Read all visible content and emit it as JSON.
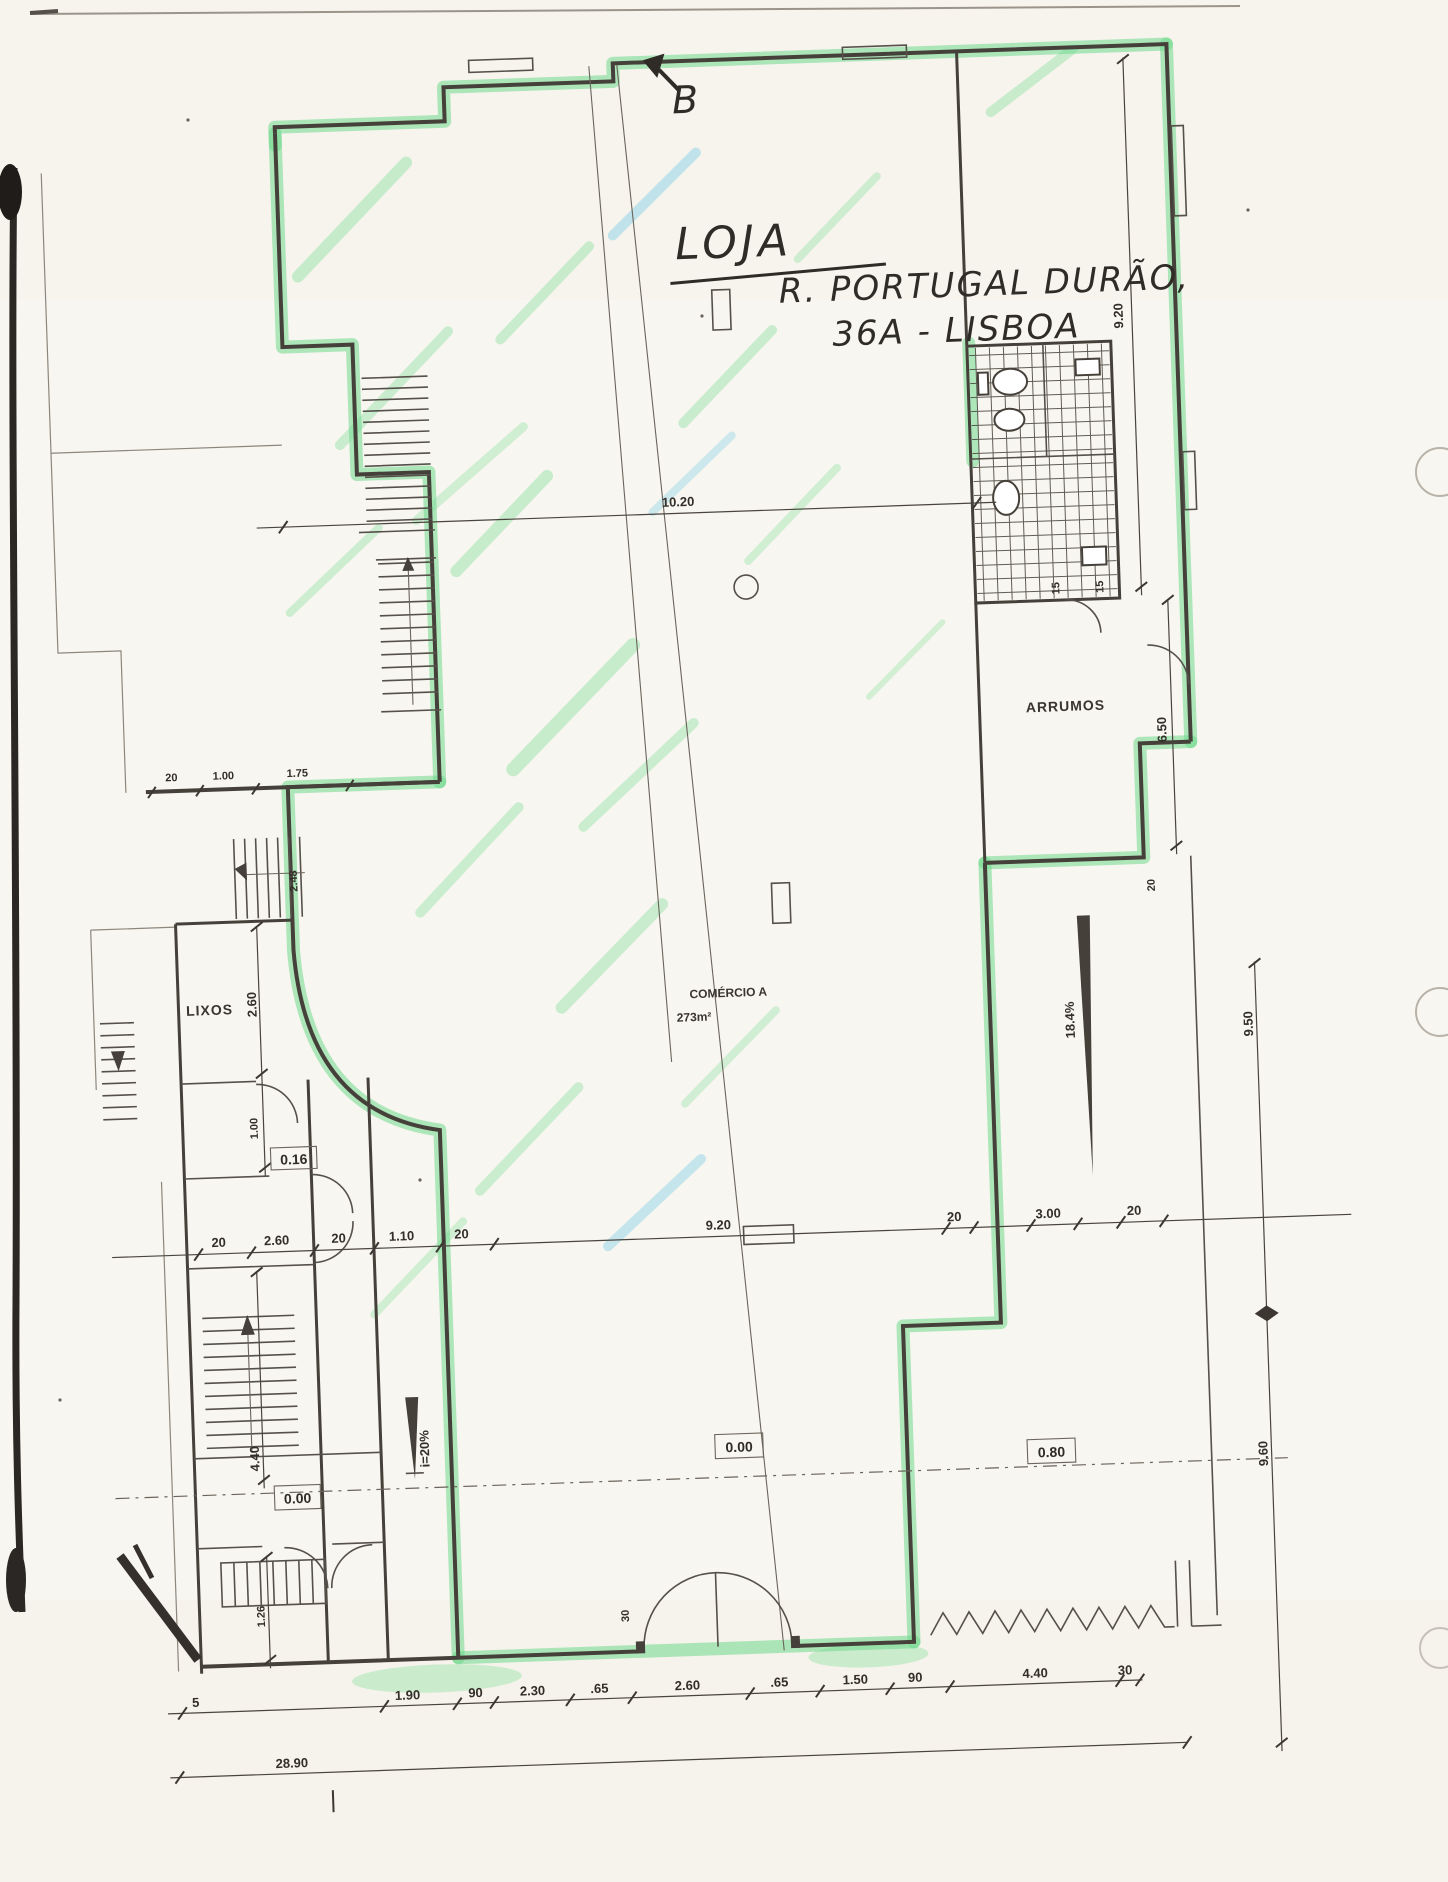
{
  "handwriting": {
    "section_letter": "B",
    "title": "LOJA",
    "address_line1": "R. PORTUGAL DURÃO,",
    "address_line2": "36A - LISBOA"
  },
  "labels": {
    "storage_room": "ARRUMOS",
    "shop_room": "COMÉRCIO A",
    "shop_area": "273m²",
    "trash_room": "LIXOS"
  },
  "levels": {
    "left_level": "0.16",
    "stair_level": "0.00",
    "shop_level": "0.00",
    "entrance_level": "0.80"
  },
  "ramps": {
    "left_ramp_slope": "i=20%",
    "right_ramp_slope": "18.4%"
  },
  "dims": {
    "top_span": "10.20",
    "right_top": "9.20",
    "wc_a": "15",
    "wc_b": "15",
    "storage_depth": "6.50",
    "storage_wall": "20",
    "right_mid_span": "9.50",
    "right_bottom_span": "9.60",
    "upper_left_row": [
      "20",
      "1.00",
      "1.75"
    ],
    "left_lixos": "2.60",
    "left_below_lixos": "1.00",
    "left_stair": "2.48",
    "left_ramp": "4.40",
    "left_bottom": "1.26",
    "door_width": "30",
    "mid_row": [
      "20",
      "2.60",
      "20",
      "1.10",
      "20",
      "9.20",
      "20",
      "3.00",
      "20"
    ],
    "bottom_row": [
      "5",
      "1.90",
      "90",
      "2.30",
      ".65",
      "2.60",
      ".65",
      "1.50",
      "90",
      "4.40",
      "30"
    ],
    "total_width": "28.90"
  }
}
